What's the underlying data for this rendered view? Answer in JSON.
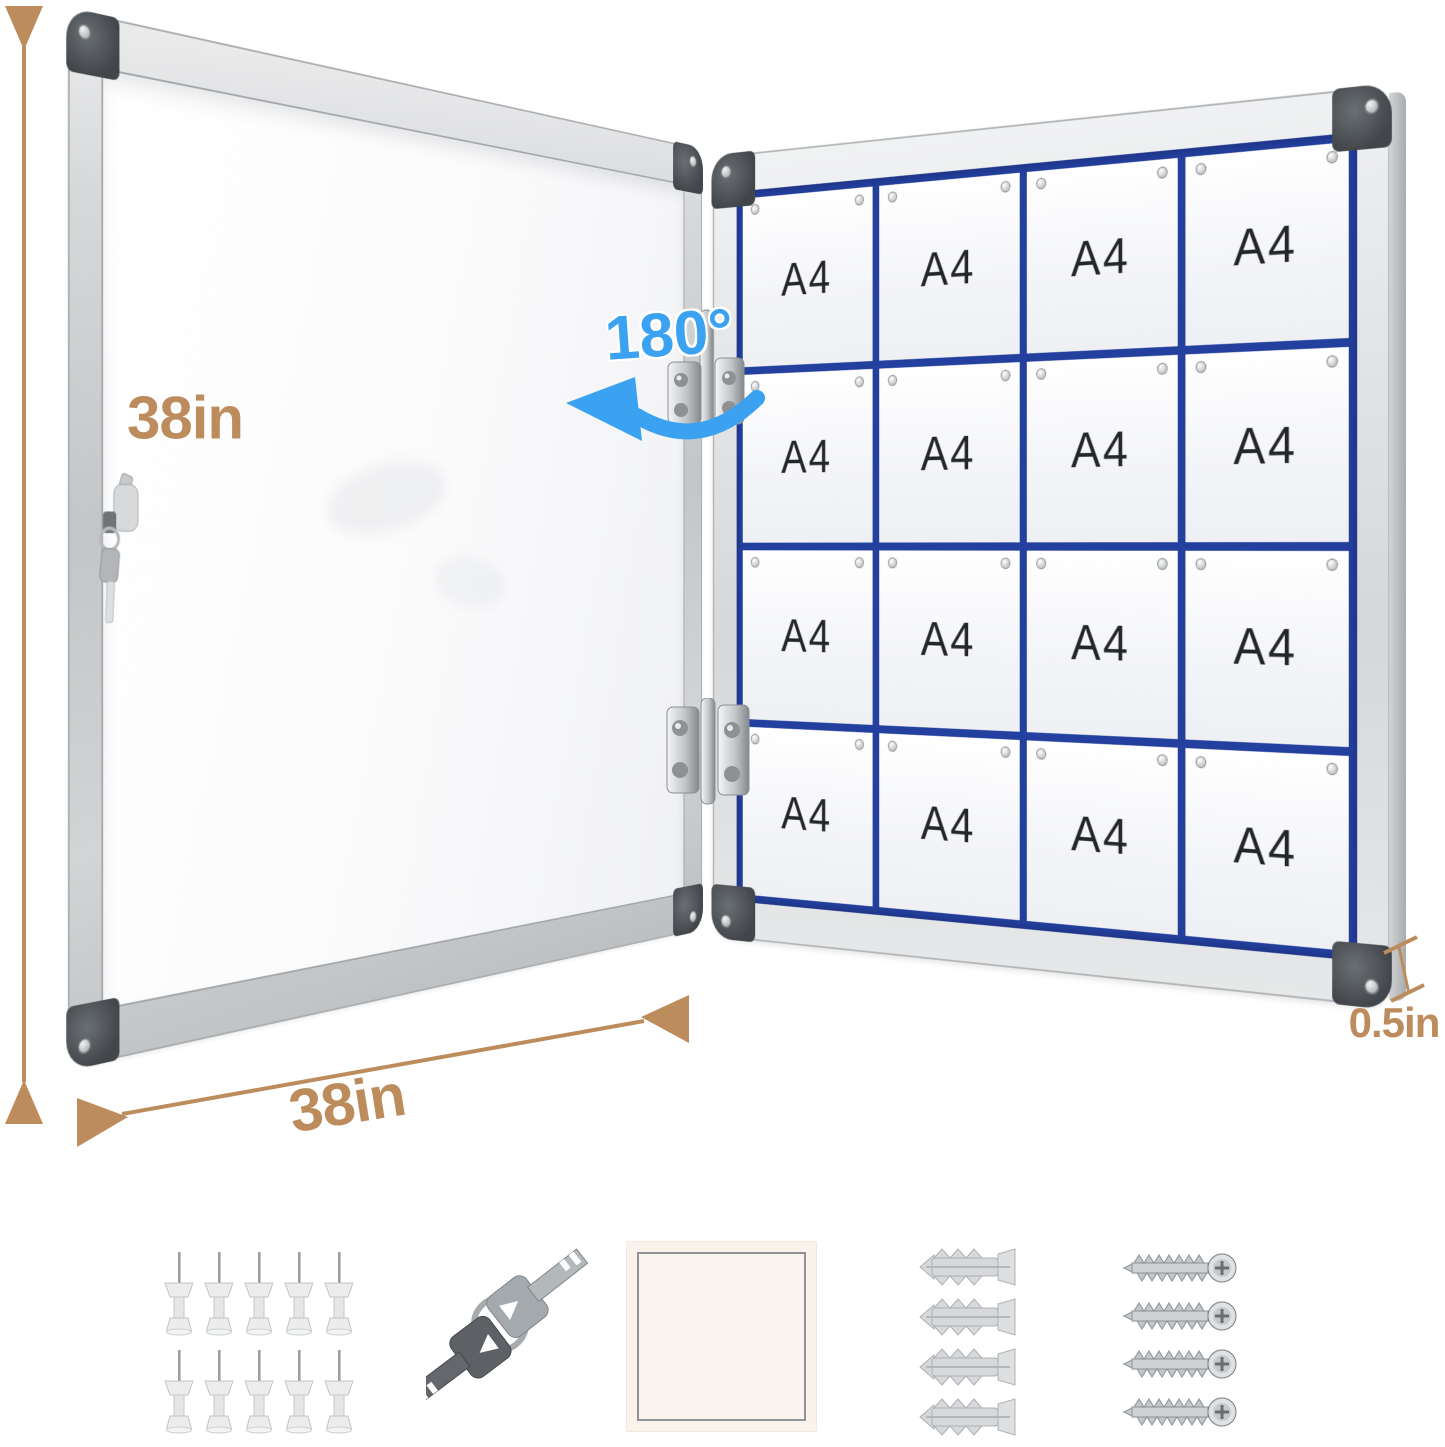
{
  "product_diagram": {
    "height_dimension_label": "38in",
    "width_dimension_label": "38in",
    "thickness_label": "0.5in",
    "door_opening_angle_label": "180°",
    "sheet_label": "A4",
    "sheet_rows": 4,
    "sheet_cols": 4,
    "sheet_count": 16
  },
  "colors": {
    "dimension_annotation": "#bd8c5d",
    "angle_annotation": "#3aa2f0",
    "board_grid_lines": "#24409f",
    "frame_silver": "#d8dadc",
    "corner_caps": "#42464a",
    "sheet_white": "#f4f5f8"
  },
  "accessories": {
    "push_pins_count": 10,
    "keys_count": 2,
    "mounting_pad_count": 1,
    "wall_anchors_count": 4,
    "screws_count": 4
  }
}
